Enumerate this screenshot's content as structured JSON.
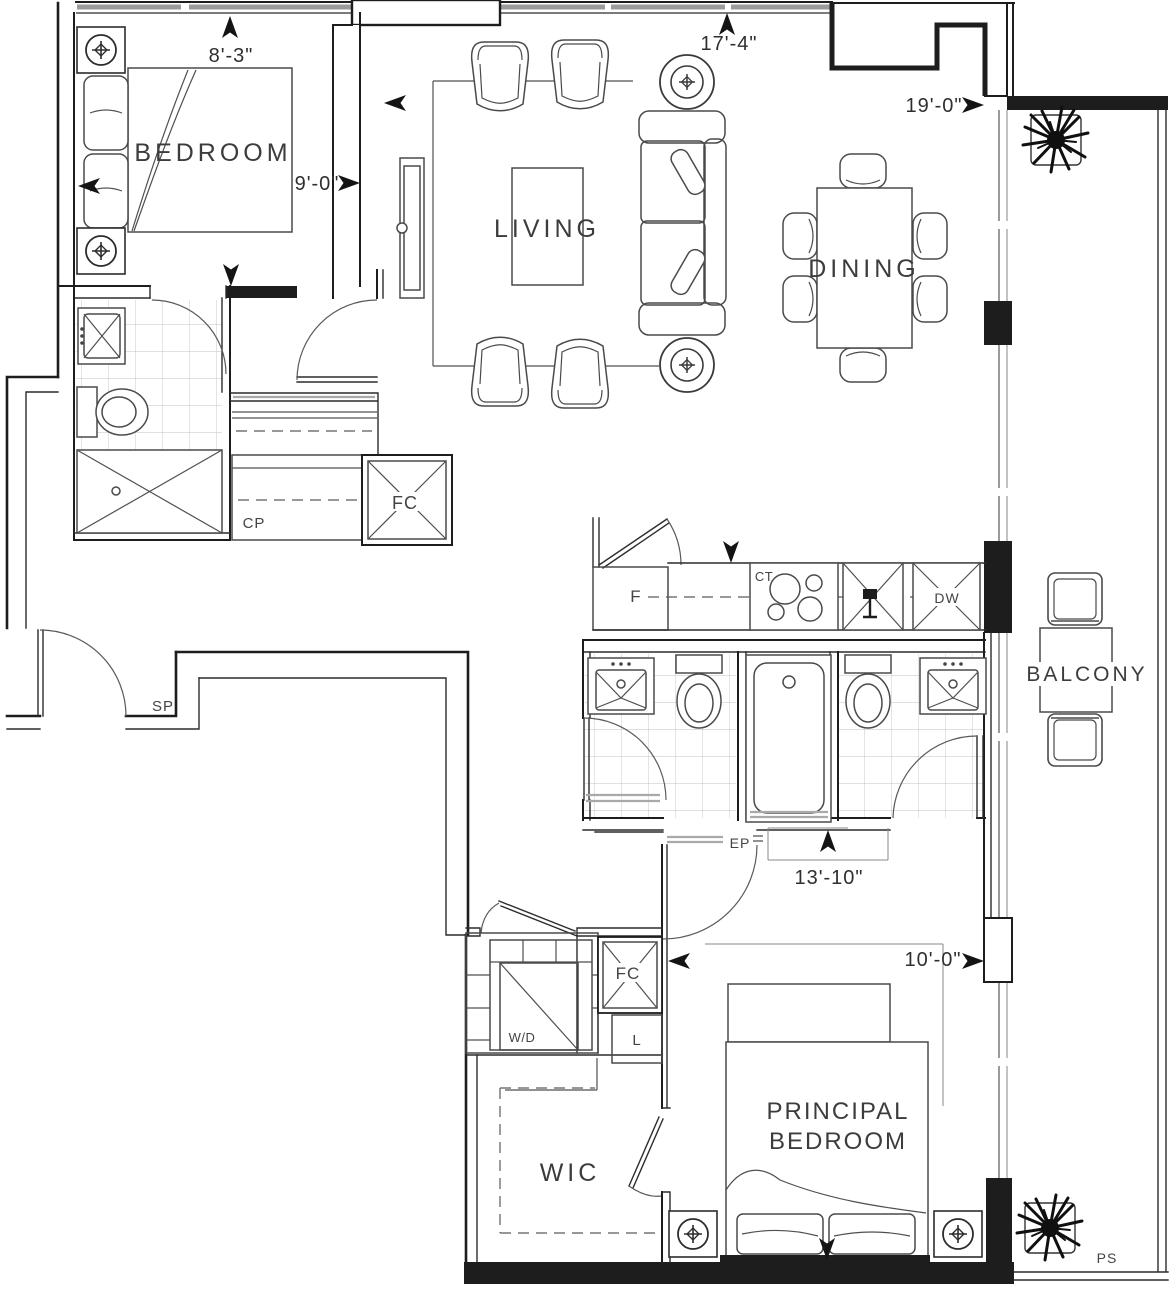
{
  "plan": {
    "title": "condo-unit-floorplan",
    "rooms": {
      "bedroom": "BEDROOM",
      "living": "LIVING",
      "dining": "DINING",
      "balcony": "BALCONY",
      "wic": "WIC",
      "principal_line1": "PRINCIPAL",
      "principal_line2": "BEDROOM"
    },
    "labels": {
      "closet": "CP",
      "fan_coil_upper": "FC",
      "fan_coil_lower": "FC",
      "fridge": "F",
      "cooktop": "CT",
      "dishwasher": "DW",
      "washer_dryer": "W/D",
      "linen": "L",
      "sprinkler": "SP",
      "electrical_panel": "EP",
      "plumbing_stack": "PS"
    },
    "dimensions": {
      "d_8_3": "8'-3\"",
      "d_9_0": "9'-0\"",
      "d_17_4": "17'-4\"",
      "d_19_0": "19'-0\"",
      "d_13_10": "13'-10\"",
      "d_10_0": "10'-0\""
    },
    "colors": {
      "wall": "#1d1d1d",
      "line": "#4a4a4a",
      "tile": "#c2c2c2",
      "glass": "#9b9b9b",
      "text": "#3c3c3c"
    }
  }
}
